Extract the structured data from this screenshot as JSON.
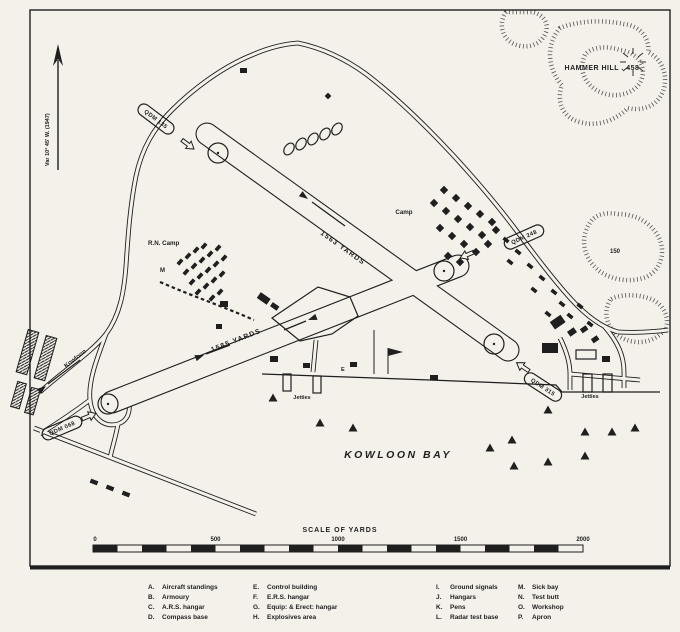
{
  "map": {
    "variation_label": "Var 10° 45' W. (1947)",
    "hammer_hill": "HAMMER HILL . 458",
    "contour_150": "150",
    "camp": "Camp",
    "rn_camp": "R.N. Camp",
    "marker_m": "M",
    "marker_e": "E",
    "kowloon_road": "Kowloon",
    "kowloon_bay": "KOWLOON BAY",
    "jetties_left": "Jetties",
    "jetties_right": "Jetties",
    "runway_13_31_length": "1563 YARDS",
    "runway_07_25_length": "1585 YARDS",
    "qdm_135": "QDM 135",
    "qdm_248": "QDM 248",
    "qdm_315": "QDM 315",
    "qdm_068": "QDM 068"
  },
  "scale_bar": {
    "title": "SCALE OF YARDS",
    "ticks": [
      "0",
      "500",
      "1000",
      "1500",
      "2000"
    ]
  },
  "legend": {
    "columns": [
      {
        "items": [
          {
            "key": "A.",
            "label": "Aircraft standings"
          },
          {
            "key": "B.",
            "label": "Armoury"
          },
          {
            "key": "C.",
            "label": "A.R.S. hangar"
          },
          {
            "key": "D.",
            "label": "Compass base"
          }
        ]
      },
      {
        "items": [
          {
            "key": "E.",
            "label": "Control building"
          },
          {
            "key": "F.",
            "label": "E.R.S. hangar"
          },
          {
            "key": "G.",
            "label": "Equip: & Erect: hangar"
          },
          {
            "key": "H.",
            "label": "Explosives area"
          }
        ]
      },
      {
        "items": [
          {
            "key": "I.",
            "label": "Ground signals"
          },
          {
            "key": "J.",
            "label": "Hangars"
          },
          {
            "key": "K.",
            "label": "Pens"
          },
          {
            "key": "L.",
            "label": "Radar test base"
          }
        ]
      },
      {
        "items": [
          {
            "key": "M.",
            "label": "Sick bay"
          },
          {
            "key": "N.",
            "label": "Test butt"
          },
          {
            "key": "O.",
            "label": "Workshop"
          },
          {
            "key": "P.",
            "label": "Apron"
          }
        ]
      }
    ]
  },
  "colors": {
    "ink": "#1f1f1f",
    "paper": "#f4f1ea"
  }
}
